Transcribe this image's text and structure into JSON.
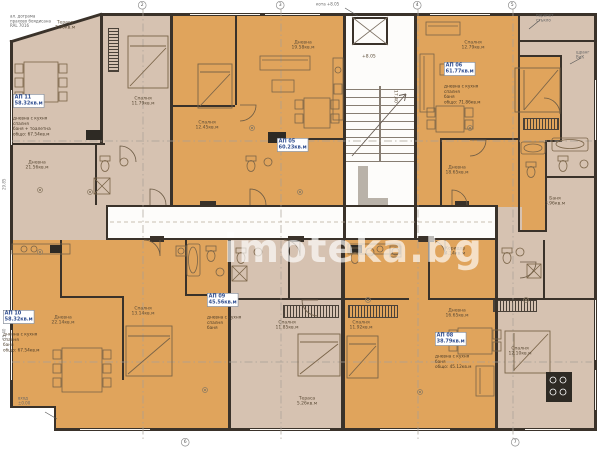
{
  "watermark": "imoteka.bg",
  "colors": {
    "apartment_orange": "#e0a45c",
    "apartment_beige": "#d6c2b1",
    "wall": "#3a322a",
    "label_blue": "#2f4d8f",
    "corridor_white": "#fdfcfa"
  },
  "plan": {
    "apartments": [
      {
        "id": "ap11",
        "number": "АП 11",
        "area": "58.32кв.м",
        "details": "дневна с кухня\nспалня\nбаня + тоалетна\nобщо: 67.54кв.м"
      },
      {
        "id": "ap05",
        "number": "АП 05",
        "area": "60.23кв.м",
        "details": ""
      },
      {
        "id": "ap06",
        "number": "АП 06",
        "area": "61.77кв.м",
        "details": "дневна с кухня\nспалня\nбаня\nобщо: 71.86кв.м"
      },
      {
        "id": "ap10",
        "number": "АП 10",
        "area": "58.32кв.м",
        "details": "дневна с кухня\nспалня\nбаня\nобщо: 67.54кв.м"
      },
      {
        "id": "ap09",
        "number": "АП 09",
        "area": "45.56кв.м",
        "details": "дневна с кухня\nспалня\nбаня"
      },
      {
        "id": "ap08",
        "number": "АП 08",
        "area": "38.79кв.м",
        "details": "дневна с кухня\nбаня\nобщо: 45.12кв.м"
      }
    ],
    "rooms": [
      {
        "name": "Тераса",
        "area": "7.56кв.м"
      },
      {
        "name": "Спалня",
        "area": "11.79кв.м"
      },
      {
        "name": "Дневна",
        "area": "21.56кв.м"
      },
      {
        "name": "Спалня",
        "area": "12.45кв.м"
      },
      {
        "name": "Дневна",
        "area": "19.58кв.м"
      },
      {
        "name": "Дневна",
        "area": "18.65кв.м"
      },
      {
        "name": "Спалня",
        "area": "12.79кв.м"
      },
      {
        "name": "Баня",
        "area": "3.96кв.м"
      },
      {
        "name": "Дневна",
        "area": "22.14кв.м"
      },
      {
        "name": "Спалня",
        "area": "13.14кв.м"
      },
      {
        "name": "Спалня",
        "area": "11.85кв.м"
      },
      {
        "name": "Спалня",
        "area": "11.92кв.м"
      },
      {
        "name": "Дневна",
        "area": "16.65кв.м"
      },
      {
        "name": "Спалня",
        "area": "12.10кв.м"
      },
      {
        "name": "Тераса",
        "area": "5.26кв.м"
      },
      {
        "name": "Коридор",
        "area": "4.14кв.м"
      }
    ],
    "core": {
      "elevation": "+8.05",
      "stair_width": "17.40"
    },
    "axes": [
      "2",
      "3",
      "4",
      "5",
      "6",
      "7"
    ],
    "annotations": [
      "ал. дограма\nпрахово боядисана\nRAL 7016",
      "парапет\nстъкло",
      "щранг\nВиК",
      "вход\n±0.00",
      "кота +8.05"
    ],
    "dims": [
      "29.85",
      "15.40"
    ]
  }
}
